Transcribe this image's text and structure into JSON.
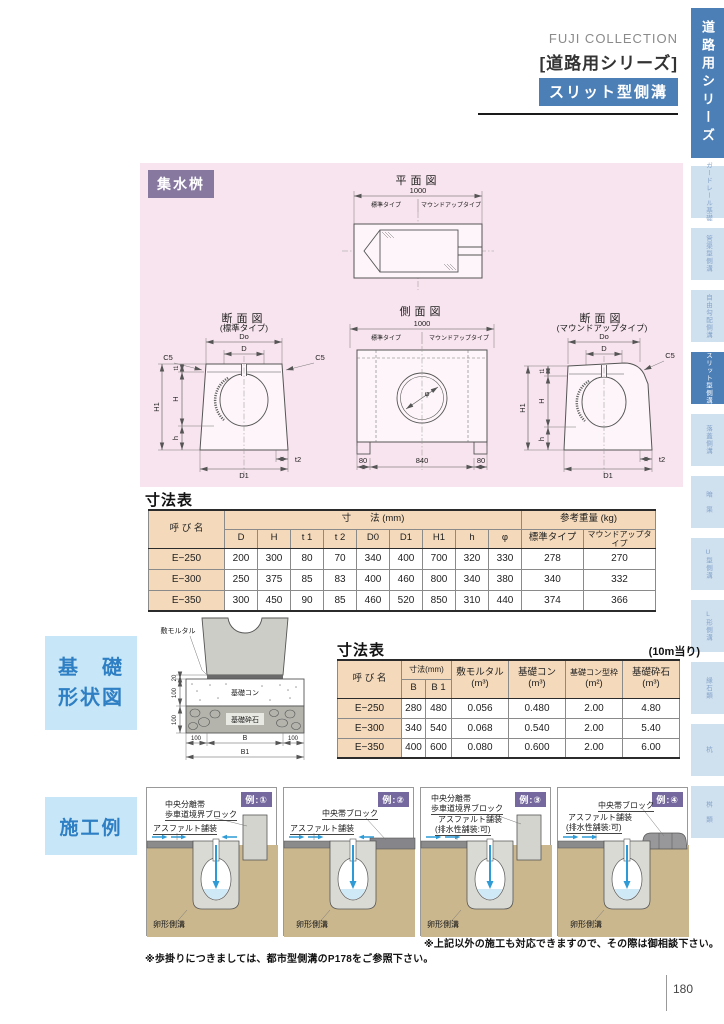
{
  "page_number": "180",
  "header": {
    "brand": "FUJI COLLECTION",
    "series": "[道路用シリーズ]",
    "badge": "スリット型側溝"
  },
  "sidebar": {
    "top_tab": "道路用シリーズ",
    "items": [
      {
        "label": "ガードレール基礎"
      },
      {
        "label": "管渠型側溝"
      },
      {
        "label": "自由勾配側溝"
      },
      {
        "label": "スリット型側溝"
      },
      {
        "label": "落蓋側溝"
      },
      {
        "label": "暗　渠"
      },
      {
        "label": "U型側溝"
      },
      {
        "label": "L形側溝"
      },
      {
        "label": "縁石類"
      },
      {
        "label": "杭"
      },
      {
        "label": "桝　類"
      }
    ]
  },
  "drawings": {
    "badge": "集水桝",
    "plan": {
      "title": "平面図",
      "dim_total": "1000",
      "type_left": "標準タイプ",
      "type_right": "マウンドアップタイプ"
    },
    "section_standard": {
      "title": "断面図",
      "subtitle": "(標準タイプ)",
      "labels": {
        "Do": "Do",
        "D": "D",
        "C5": "C5",
        "t1": "t1",
        "H": "H",
        "H1": "H1",
        "h": "h",
        "t2": "t2",
        "D1": "D1"
      }
    },
    "side": {
      "title": "側面図",
      "dim_total": "1000",
      "type_left": "標準タイプ",
      "type_right": "マウンドアップタイプ",
      "phi": "φ",
      "dims_bottom": [
        "80",
        "840",
        "80"
      ]
    },
    "section_mound": {
      "title": "断面図",
      "subtitle": "(マウンドアップタイプ)",
      "labels": {
        "Do": "Do",
        "D": "D",
        "C5": "C5",
        "t1": "t1",
        "H": "H",
        "H1": "H1",
        "h": "h",
        "t2": "t2",
        "D1": "D1"
      }
    }
  },
  "dim_table": {
    "title": "寸法表",
    "col_name": "呼  び  名",
    "group_dims": "寸　　法 (mm)",
    "group_weight": "参考重量 (kg)",
    "dim_cols": [
      "D",
      "H",
      "t 1",
      "t 2",
      "D0",
      "D1",
      "H1",
      "h",
      "φ"
    ],
    "weight_cols": [
      "標準タイプ",
      "マウンドアップタイプ"
    ],
    "rows": [
      {
        "name": "E−250",
        "dims": [
          "200",
          "300",
          "80",
          "70",
          "340",
          "400",
          "700",
          "320",
          "330"
        ],
        "weights": [
          "278",
          "270"
        ]
      },
      {
        "name": "E−300",
        "dims": [
          "250",
          "375",
          "85",
          "83",
          "400",
          "460",
          "800",
          "340",
          "380"
        ],
        "weights": [
          "340",
          "332"
        ]
      },
      {
        "name": "E−350",
        "dims": [
          "300",
          "450",
          "90",
          "85",
          "460",
          "520",
          "850",
          "310",
          "440"
        ],
        "weights": [
          "374",
          "366"
        ]
      }
    ]
  },
  "foundation": {
    "box_line1": "基　礎",
    "box_line2": "形状図",
    "diagram": {
      "mortar": "敷モルタル",
      "concrete": "基礎コン",
      "crushed": "基礎砕石",
      "d20": "20",
      "d100a": "100",
      "d100b": "100",
      "b_left": "100",
      "b": "B",
      "b_right": "100",
      "b1": "B1"
    }
  },
  "base_table": {
    "title": "寸法表",
    "per_note": "(10m当り)",
    "col_name": "呼  び  名",
    "group_dims": "寸法(mm)",
    "dim_cols": [
      "B",
      "B 1"
    ],
    "qty_cols": [
      {
        "name": "敷モルタル",
        "unit": "(m³)"
      },
      {
        "name": "基礎コン",
        "unit": "(m³)"
      },
      {
        "name": "基礎コン型枠",
        "unit": "(m²)"
      },
      {
        "name": "基礎砕石",
        "unit": "(m³)"
      }
    ],
    "rows": [
      {
        "name": "E−250",
        "b": "280",
        "b1": "480",
        "vals": [
          "0.056",
          "0.480",
          "2.00",
          "4.80"
        ]
      },
      {
        "name": "E−300",
        "b": "340",
        "b1": "540",
        "vals": [
          "0.068",
          "0.540",
          "2.00",
          "5.40"
        ]
      },
      {
        "name": "E−350",
        "b": "400",
        "b1": "600",
        "vals": [
          "0.080",
          "0.600",
          "2.00",
          "6.00"
        ]
      }
    ]
  },
  "examples": {
    "box_title": "施工例",
    "panels": [
      {
        "badge": "例:①",
        "labels": [
          "中央分離帯",
          "歩車道境界ブロック",
          "アスファルト舗装"
        ],
        "bottom": "卵形側溝"
      },
      {
        "badge": "例:②",
        "labels": [
          "中央帯ブロック",
          "アスファルト舗装"
        ],
        "bottom": "卵形側溝"
      },
      {
        "badge": "例:③",
        "labels": [
          "中央分離帯",
          "歩車道境界ブロック",
          "アスファルト舗装",
          "(排水性舗装:可)"
        ],
        "bottom": "卵形側溝"
      },
      {
        "badge": "例:④",
        "labels": [
          "中央帯ブロック",
          "アスファルト舗装",
          "(排水性舗装:可)"
        ],
        "bottom": "卵形側溝"
      }
    ],
    "note_right": "※上記以外の施工も対応できますので、その際は御相談下さい。",
    "note_left": "※歩掛りにつきましては、都市型側溝のP178をご参照下さい。"
  }
}
